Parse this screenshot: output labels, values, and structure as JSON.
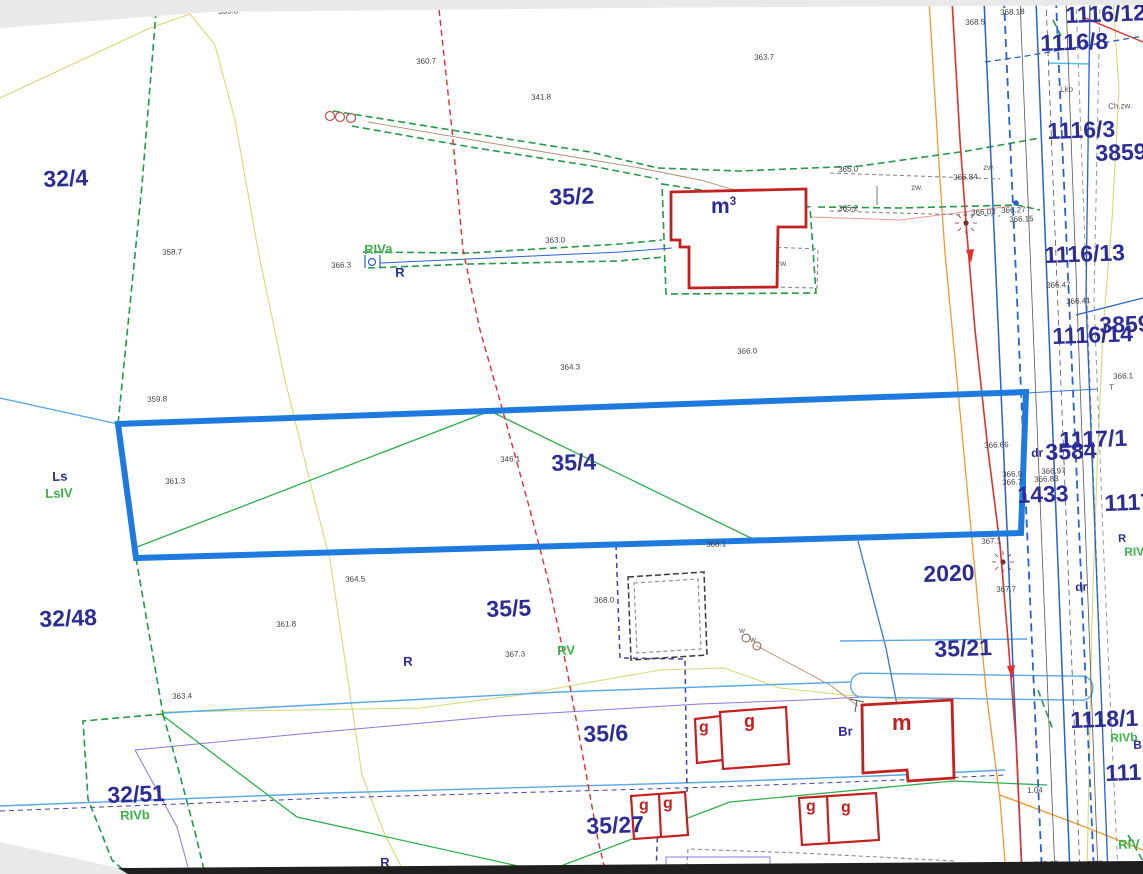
{
  "colors": {
    "selected_parcel": "#1f7ae0",
    "parcel_text": "#2c2c96",
    "soil_text_green": "#3db04a",
    "building_stroke": "#c42020",
    "boundary_green": "#229a46",
    "stream_red": "#e03030",
    "utility_orange": "#f2992e",
    "water_blue": "#58a8e8",
    "utility_purple": "#8878e0"
  },
  "selected_parcel_number": "35/4",
  "labels": {
    "parcels": [
      {
        "t": "32/4",
        "x": 43,
        "y": 168
      },
      {
        "t": "35/2",
        "x": 549,
        "y": 186
      },
      {
        "t": "35/4",
        "x": 551,
        "y": 452
      },
      {
        "t": "35/5",
        "x": 486,
        "y": 598
      },
      {
        "t": "35/6",
        "x": 583,
        "y": 723
      },
      {
        "t": "35/27",
        "x": 586,
        "y": 815
      },
      {
        "t": "32/48",
        "x": 39,
        "y": 608
      },
      {
        "t": "32/51",
        "x": 107,
        "y": 784
      },
      {
        "t": "35/21",
        "x": 934,
        "y": 638
      },
      {
        "t": "2020",
        "x": 923,
        "y": 563
      },
      {
        "t": "1433",
        "x": 1017,
        "y": 484
      },
      {
        "t": "3584",
        "x": 1045,
        "y": 441
      },
      {
        "t": "1117/1",
        "x": 1059,
        "y": 429
      },
      {
        "t": "1116/12",
        "x": 1065,
        "y": 4
      },
      {
        "t": "1116/8",
        "x": 1040,
        "y": 32
      },
      {
        "t": "1116/3",
        "x": 1047,
        "y": 120
      },
      {
        "t": "3859",
        "x": 1095,
        "y": 142
      },
      {
        "t": "1116/13",
        "x": 1044,
        "y": 244
      },
      {
        "t": "3859",
        "x": 1099,
        "y": 314
      },
      {
        "t": "1116/14",
        "x": 1052,
        "y": 325
      },
      {
        "t": "1117",
        "x": 1104,
        "y": 492
      },
      {
        "t": "1118/1",
        "x": 1070,
        "y": 709
      },
      {
        "t": "111",
        "x": 1105,
        "y": 762
      }
    ],
    "soil": [
      {
        "t": "Ls",
        "x": 52,
        "y": 470,
        "c": "n"
      },
      {
        "t": "LsIV",
        "x": 45,
        "y": 487,
        "c": "g"
      },
      {
        "t": "RIVa",
        "x": 364,
        "y": 243,
        "c": "g"
      },
      {
        "t": "R",
        "x": 395,
        "y": 266,
        "c": "n"
      },
      {
        "t": "RV",
        "x": 557,
        "y": 644,
        "c": "g"
      },
      {
        "t": "R",
        "x": 403,
        "y": 655,
        "c": "n"
      },
      {
        "t": "RIVb",
        "x": 120,
        "y": 809,
        "c": "g"
      },
      {
        "t": "R",
        "x": 1118,
        "y": 534,
        "c": "n",
        "s": 11
      },
      {
        "t": "RIV",
        "x": 1124,
        "y": 546,
        "c": "g",
        "s": 12
      },
      {
        "t": "RIVb",
        "x": 1110,
        "y": 732,
        "c": "g",
        "s": 12
      },
      {
        "t": "B",
        "x": 1133,
        "y": 739,
        "c": "n",
        "s": 12
      },
      {
        "t": "RIV",
        "x": 1118,
        "y": 838,
        "c": "g"
      },
      {
        "t": "dr",
        "x": 1031,
        "y": 447,
        "c": "n",
        "s": 12
      },
      {
        "t": "dr",
        "x": 1075,
        "y": 581,
        "c": "n",
        "s": 12
      },
      {
        "t": "Br",
        "x": 838,
        "y": 725,
        "c": "n"
      },
      {
        "t": "R",
        "x": 380,
        "y": 856,
        "c": "n"
      }
    ],
    "elevations": [
      {
        "t": "359.8",
        "x": 218,
        "y": 8
      },
      {
        "t": "368.18",
        "x": 1000,
        "y": 9
      },
      {
        "t": "368.5",
        "x": 965,
        "y": 19
      },
      {
        "t": "360.7",
        "x": 416,
        "y": 58
      },
      {
        "t": "363.7",
        "x": 754,
        "y": 54
      },
      {
        "t": "341.8",
        "x": 531,
        "y": 94
      },
      {
        "t": "358.7",
        "x": 162,
        "y": 249
      },
      {
        "t": "366.3",
        "x": 331,
        "y": 262
      },
      {
        "t": "363.0",
        "x": 545,
        "y": 237
      },
      {
        "t": "365.0",
        "x": 838,
        "y": 166
      },
      {
        "t": "365.2",
        "x": 838,
        "y": 205
      },
      {
        "t": "365.84",
        "x": 953,
        "y": 174
      },
      {
        "t": "366.03",
        "x": 971,
        "y": 209
      },
      {
        "t": "366.27",
        "x": 1001,
        "y": 207
      },
      {
        "t": "366.15",
        "x": 1009,
        "y": 216
      },
      {
        "t": "364.3",
        "x": 560,
        "y": 364
      },
      {
        "t": "366.0",
        "x": 737,
        "y": 348
      },
      {
        "t": "359.8",
        "x": 147,
        "y": 396
      },
      {
        "t": "361.3",
        "x": 165,
        "y": 478
      },
      {
        "t": "346.1",
        "x": 500,
        "y": 456
      },
      {
        "t": "368.1",
        "x": 706,
        "y": 541
      },
      {
        "t": "364.5",
        "x": 345,
        "y": 576
      },
      {
        "t": "361.8",
        "x": 276,
        "y": 621
      },
      {
        "t": "368.0",
        "x": 594,
        "y": 597
      },
      {
        "t": "367.3",
        "x": 505,
        "y": 651
      },
      {
        "t": "363.4",
        "x": 172,
        "y": 693
      },
      {
        "t": "367.1",
        "x": 981,
        "y": 538
      },
      {
        "t": "367.7",
        "x": 996,
        "y": 586
      },
      {
        "t": "366.66",
        "x": 984,
        "y": 442
      },
      {
        "t": "366.9",
        "x": 1002,
        "y": 471
      },
      {
        "t": "366.7",
        "x": 1002,
        "y": 479
      },
      {
        "t": "366.97",
        "x": 1041,
        "y": 468
      },
      {
        "t": "366.83",
        "x": 1034,
        "y": 476
      },
      {
        "t": "366.47",
        "x": 1046,
        "y": 282
      },
      {
        "t": "366.41",
        "x": 1066,
        "y": 298
      },
      {
        "t": "366.1",
        "x": 1113,
        "y": 373
      },
      {
        "t": "368.05",
        "x": 1034,
        "y": 861
      },
      {
        "t": "368.27",
        "x": 1078,
        "y": 861
      },
      {
        "t": "1.04",
        "x": 1027,
        "y": 787
      }
    ],
    "buildings": [
      {
        "t": "m",
        "sup": "3",
        "x": 711,
        "y": 196,
        "c": "navy",
        "s": 21
      },
      {
        "t": "m",
        "x": 892,
        "y": 712,
        "c": "red",
        "s": 22
      },
      {
        "t": "g",
        "x": 699,
        "y": 720,
        "c": "red",
        "s": 16
      },
      {
        "t": "g",
        "x": 744,
        "y": 712,
        "c": "red",
        "s": 18
      },
      {
        "t": "g",
        "x": 639,
        "y": 798,
        "c": "red",
        "s": 16
      },
      {
        "t": "g",
        "x": 663,
        "y": 796,
        "c": "red",
        "s": 16
      },
      {
        "t": "g",
        "x": 806,
        "y": 799,
        "c": "red",
        "s": 16
      },
      {
        "t": "g",
        "x": 841,
        "y": 800,
        "c": "red",
        "s": 16
      }
    ],
    "misc": [
      {
        "t": "zw.",
        "x": 776,
        "y": 260
      },
      {
        "t": "zw.",
        "x": 911,
        "y": 184
      },
      {
        "t": "zw.",
        "x": 983,
        "y": 164
      },
      {
        "t": "Ch.zw.",
        "x": 1108,
        "y": 103
      },
      {
        "t": "Lkb",
        "x": 1060,
        "y": 86
      },
      {
        "t": "w",
        "x": 739,
        "y": 627
      },
      {
        "t": "w",
        "x": 750,
        "y": 636
      },
      {
        "t": "T",
        "x": 1109,
        "y": 384
      }
    ]
  }
}
